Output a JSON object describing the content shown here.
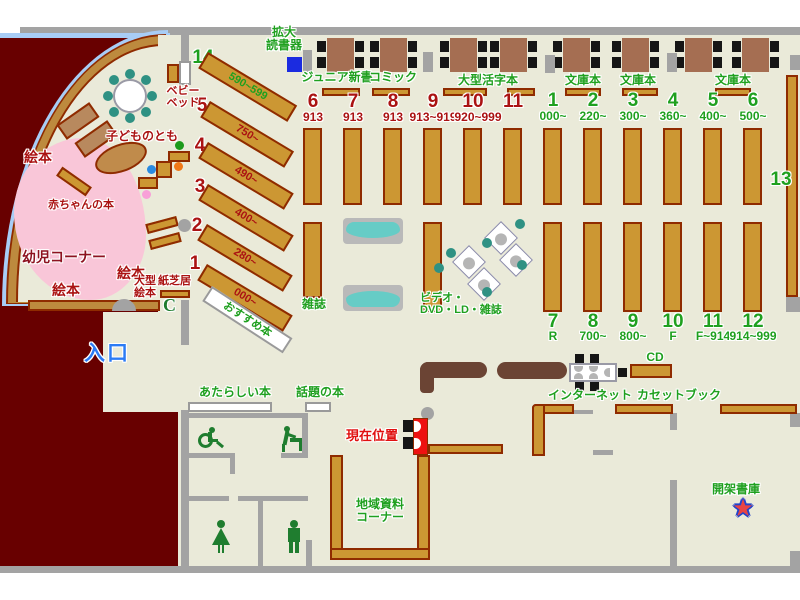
{
  "colors": {
    "exterior": "#680000",
    "floor": "#eaead9",
    "wall_gray": "#a3a3a3",
    "shelf_gold": "#cc9733",
    "shelf_border": "#8f2b00",
    "table_brown": "#a56e52",
    "counter_brown": "#6b4434",
    "accent_red": "#aa1212",
    "accent_green": "#1fa01f",
    "entrance_blue": "#2b7bf5",
    "toddler_pink": "#f9c6d8",
    "sofa_teal": "#66ccc6",
    "chair_teal": "#2f9183",
    "marker_red": "#ee1111",
    "reader_blue": "#1b2be0"
  },
  "top": {
    "reader": "拡大\n読書器",
    "sections": [
      "ジュニア新書",
      "コミック",
      "大型活字本",
      "文庫本",
      "文庫本",
      "文庫本"
    ]
  },
  "upper_red": {
    "nums": [
      "6",
      "7",
      "8",
      "9",
      "10",
      "11"
    ],
    "ranges": [
      "913",
      "913",
      "913",
      "913~919",
      "920~999"
    ]
  },
  "upper_green": {
    "nums": [
      "1",
      "2",
      "3",
      "4",
      "5",
      "6"
    ],
    "ranges": [
      "000~",
      "220~",
      "300~",
      "360~",
      "400~",
      "500~"
    ]
  },
  "lower_green": {
    "nums": [
      "7",
      "8",
      "9",
      "10",
      "11",
      "12"
    ],
    "ranges": [
      "R",
      "700~",
      "800~",
      "F",
      "F~914",
      "914~999"
    ]
  },
  "wall_shelf": {
    "num": "13"
  },
  "kids": {
    "num14": "14",
    "range14": "590~599",
    "diag": [
      {
        "num": "5",
        "range": "750~"
      },
      {
        "num": "4",
        "range": "490~"
      },
      {
        "num": "3",
        "range": "400~"
      },
      {
        "num": "2",
        "range": "280~"
      },
      {
        "num": "1",
        "range": "000~"
      }
    ],
    "baby_bed": "ベビー\nベッド",
    "kodomo": "子どものとも",
    "akachan": "赤ちゃんの本",
    "yoji": "幼児コーナー",
    "ehon": [
      "絵本",
      "絵本",
      "絵本"
    ],
    "ogata": "大型\n絵本",
    "kamishibai": "紙芝居"
  },
  "center": {
    "zasshi": "雑誌",
    "video": "ビデオ・\nDVD・LD・雑誌",
    "osusume": "おすすめ本",
    "entrance": "入口",
    "atarashii": "あたらしい本",
    "wadai": "話題の本",
    "genzai": "現在位置",
    "chiiki": "地域資料\nコーナー",
    "internet": "インターネット",
    "cd": "CD",
    "cassette": "カセットブック",
    "kaika": "開架書庫",
    "phone": "C"
  }
}
